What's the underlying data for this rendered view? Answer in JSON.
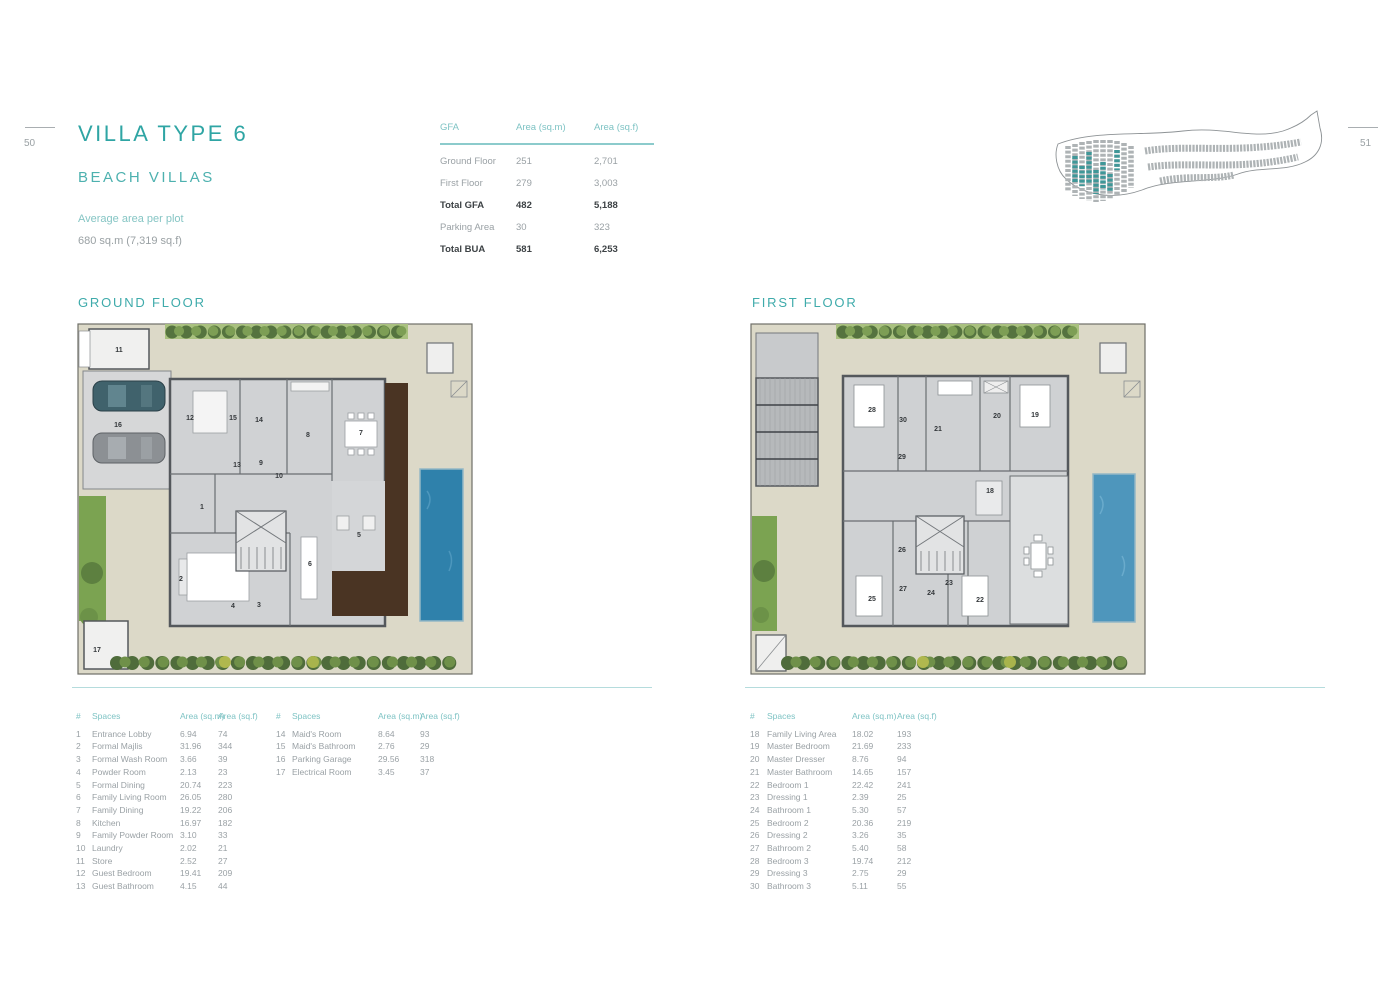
{
  "page": {
    "left_number": "50",
    "right_number": "51"
  },
  "header": {
    "title": "VILLA TYPE 6",
    "subtitle": "BEACH VILLAS",
    "avg_label": "Average area per plot",
    "avg_value": "680 sq.m (7,319 sq.f)"
  },
  "gfa_table": {
    "headers": [
      "GFA",
      "Area (sq.m)",
      "Area (sq.f)"
    ],
    "rows": [
      {
        "label": "Ground Floor",
        "sqm": "251",
        "sqf": "2,701",
        "bold": false
      },
      {
        "label": "First Floor",
        "sqm": "279",
        "sqf": "3,003",
        "bold": false
      },
      {
        "label": "Total GFA",
        "sqm": "482",
        "sqf": "5,188",
        "bold": true
      },
      {
        "label": "Parking Area",
        "sqm": "30",
        "sqf": "323",
        "bold": false
      },
      {
        "label": "Total BUA",
        "sqm": "581",
        "sqf": "6,253",
        "bold": true
      }
    ]
  },
  "sections": {
    "ground": "GROUND FLOOR",
    "first": "FIRST FLOOR"
  },
  "spaces_headers": [
    "#",
    "Spaces",
    "Area (sq.m)",
    "Area (sq.f)"
  ],
  "spaces_ground_col1": [
    [
      "1",
      "Entrance Lobby",
      "6.94",
      "74"
    ],
    [
      "2",
      "Formal Majlis",
      "31.96",
      "344"
    ],
    [
      "3",
      "Formal Wash Room",
      "3.66",
      "39"
    ],
    [
      "4",
      "Powder Room",
      "2.13",
      "23"
    ],
    [
      "5",
      "Formal Dining",
      "20.74",
      "223"
    ],
    [
      "6",
      "Family Living Room",
      "26.05",
      "280"
    ],
    [
      "7",
      "Family Dining",
      "19.22",
      "206"
    ],
    [
      "8",
      "Kitchen",
      "16.97",
      "182"
    ],
    [
      "9",
      "Family Powder Room",
      "3.10",
      "33"
    ],
    [
      "10",
      "Laundry",
      "2.02",
      "21"
    ],
    [
      "11",
      "Store",
      "2.52",
      "27"
    ],
    [
      "12",
      "Guest Bedroom",
      "19.41",
      "209"
    ],
    [
      "13",
      "Guest Bathroom",
      "4.15",
      "44"
    ]
  ],
  "spaces_ground_col2": [
    [
      "14",
      "Maid's Room",
      "8.64",
      "93"
    ],
    [
      "15",
      "Maid's Bathroom",
      "2.76",
      "29"
    ],
    [
      "16",
      "Parking Garage",
      "29.56",
      "318"
    ],
    [
      "17",
      "Electrical Room",
      "3.45",
      "37"
    ]
  ],
  "spaces_first": [
    [
      "18",
      "Family Living Area",
      "18.02",
      "193"
    ],
    [
      "19",
      "Master Bedroom",
      "21.69",
      "233"
    ],
    [
      "20",
      "Master Dresser",
      "8.76",
      "94"
    ],
    [
      "21",
      "Master Bathroom",
      "14.65",
      "157"
    ],
    [
      "22",
      "Bedroom 1",
      "22.42",
      "241"
    ],
    [
      "23",
      "Dressing 1",
      "2.39",
      "25"
    ],
    [
      "24",
      "Bathroom 1",
      "5.30",
      "57"
    ],
    [
      "25",
      "Bedroom 2",
      "20.36",
      "219"
    ],
    [
      "26",
      "Dressing 2",
      "3.26",
      "35"
    ],
    [
      "27",
      "Bathroom 2",
      "5.40",
      "58"
    ],
    [
      "28",
      "Bedroom 3",
      "19.74",
      "212"
    ],
    [
      "29",
      "Dressing 3",
      "2.75",
      "29"
    ],
    [
      "30",
      "Bathroom 3",
      "5.11",
      "55"
    ]
  ],
  "plans": {
    "ground_rooms": [
      {
        "n": "11",
        "x": 44,
        "y": 31
      },
      {
        "n": "16",
        "x": 43,
        "y": 106
      },
      {
        "n": "12",
        "x": 115,
        "y": 99
      },
      {
        "n": "15",
        "x": 158,
        "y": 99
      },
      {
        "n": "14",
        "x": 184,
        "y": 101
      },
      {
        "n": "13",
        "x": 162,
        "y": 146
      },
      {
        "n": "9",
        "x": 186,
        "y": 144
      },
      {
        "n": "1",
        "x": 127,
        "y": 188
      },
      {
        "n": "10",
        "x": 204,
        "y": 157
      },
      {
        "n": "8",
        "x": 233,
        "y": 116
      },
      {
        "n": "7",
        "x": 286,
        "y": 114
      },
      {
        "n": "5",
        "x": 284,
        "y": 216
      },
      {
        "n": "2",
        "x": 106,
        "y": 260
      },
      {
        "n": "4",
        "x": 158,
        "y": 287
      },
      {
        "n": "3",
        "x": 184,
        "y": 286
      },
      {
        "n": "6",
        "x": 235,
        "y": 245
      },
      {
        "n": "17",
        "x": 22,
        "y": 331
      }
    ],
    "first_rooms": [
      {
        "n": "28",
        "x": 124,
        "y": 91
      },
      {
        "n": "30",
        "x": 155,
        "y": 101
      },
      {
        "n": "29",
        "x": 154,
        "y": 138
      },
      {
        "n": "21",
        "x": 190,
        "y": 110
      },
      {
        "n": "20",
        "x": 249,
        "y": 97
      },
      {
        "n": "19",
        "x": 287,
        "y": 96
      },
      {
        "n": "18",
        "x": 242,
        "y": 172
      },
      {
        "n": "26",
        "x": 154,
        "y": 231
      },
      {
        "n": "25",
        "x": 124,
        "y": 280
      },
      {
        "n": "27",
        "x": 155,
        "y": 270
      },
      {
        "n": "24",
        "x": 183,
        "y": 274
      },
      {
        "n": "23",
        "x": 201,
        "y": 264
      },
      {
        "n": "22",
        "x": 232,
        "y": 281
      }
    ]
  },
  "colors": {
    "accent_teal": "#2fa5a4",
    "table_header_teal": "#7ec3c4",
    "divider_teal": "#b5dcdd",
    "pool_ground": "#2f81ab",
    "pool_first": "#4e96bc",
    "wood_deck": "#4a3423",
    "lawn_green": "#7ba351",
    "hedge_green": "#55733f",
    "plot_beige": "#dcd9c8",
    "map_highlight": "#3f9798"
  }
}
